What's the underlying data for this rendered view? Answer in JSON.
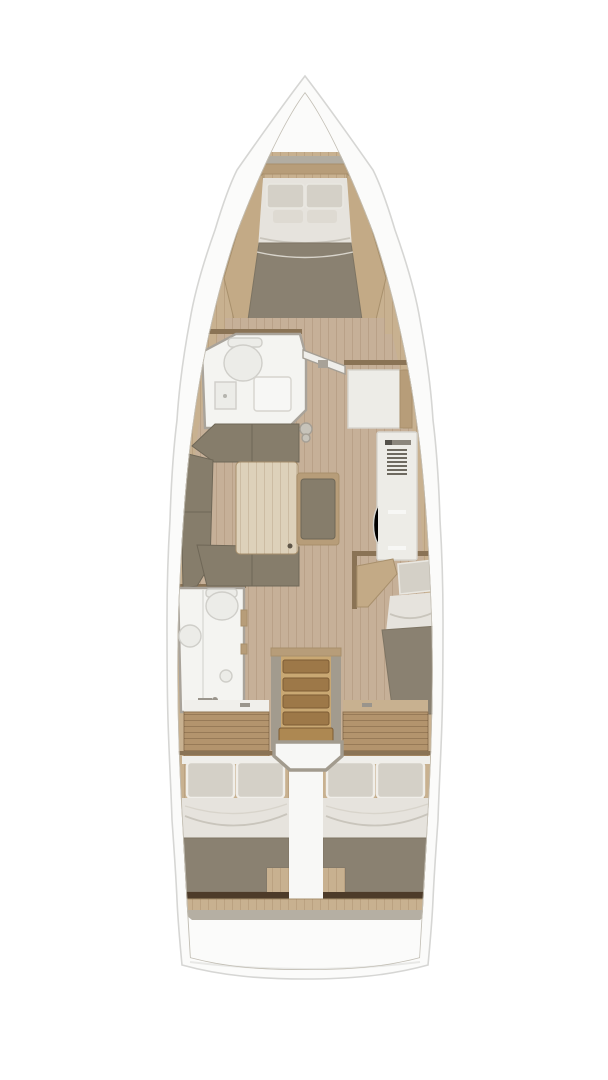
{
  "figure": {
    "type": "floorplan",
    "subject": "sailing-yacht-interior-top-view",
    "rooms": {
      "forward_cabin": "forward-v-berth-cabin",
      "forward_head": "forward-bathroom",
      "salon": "salon-u-sofa-and-table",
      "wardrobe_unit": "white-wardrobe-chart-unit",
      "galley_unit": "tall-galley-fridge-unit",
      "aft_head": "aft-bathroom",
      "mid_cabin": "mid-single-berth-cabin",
      "companionway": "companionway-stairs",
      "aft_cabin_port": "aft-double-cabin-port",
      "aft_cabin_starboard": "aft-double-cabin-starboard"
    }
  },
  "colors": {
    "page_bg": "#ffffff",
    "hull": "#fbfbfa",
    "hull_outline": "#d6d6d4",
    "deck_line": "#c2beb4",
    "wood_light": "#c8b190",
    "wood_mid": "#b79d79",
    "wood_dark": "#8a7355",
    "wood_panel": "#c3aa86",
    "floor": "#c6b098",
    "upholstery": "#867d6b",
    "blanket": "#8a8171",
    "sheet": "#e6e3dd",
    "pillow": "#d4d0c7",
    "pillow_small": "#dedad2",
    "bathroom": "#f4f4f1",
    "fixture": "#ecece8",
    "white_unit": "#edece7",
    "gray_trim": "#a29b8e",
    "gray_shelf": "#b2ada2",
    "stair_tread": "#9d7848",
    "stair_light": "#c9a873",
    "stair_big": "#ad8852",
    "cabinet": "#b3946d",
    "dark_shelf": "#4d3b29",
    "gray_band": "#b5afa3",
    "white_soft": "#f7f7f5",
    "corridor": "#f8f8f6",
    "table": "#ddd1ba",
    "metal": "#9a958c",
    "grille": "#6e6a60",
    "headboard": "#efeeea",
    "counter_white": "#f0efeb",
    "door_leaf": "#efeeea",
    "fitting": "#c7c3ba"
  }
}
